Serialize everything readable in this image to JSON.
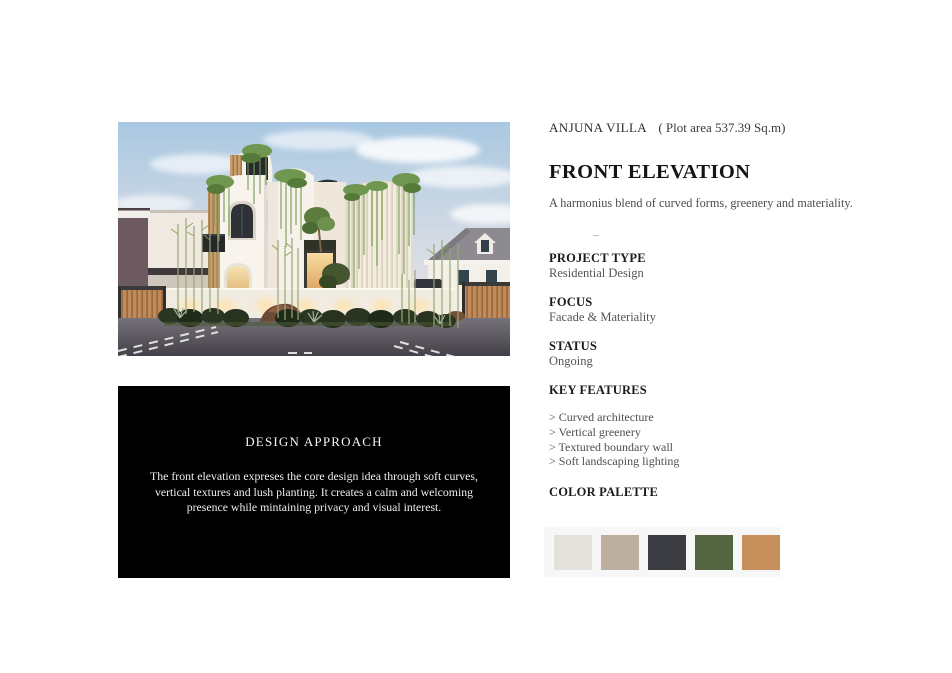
{
  "header": {
    "project_name": "ANJUNA VILLA",
    "plot_area": "( Plot area 537.39 Sq.m)",
    "title": "FRONT ELEVATION",
    "subtitle": "A harmonius blend of curved forms, greenery and materiality.",
    "divider": "–"
  },
  "details": {
    "items": [
      {
        "label": "PROJECT TYPE",
        "value": "Residential Design"
      },
      {
        "label": "FOCUS",
        "value": "Facade & Materiality"
      },
      {
        "label": "STATUS",
        "value": "Ongoing"
      }
    ]
  },
  "key_features": {
    "label": "KEY FEATURES",
    "items": [
      "> Curved architecture",
      "> Vertical greenery",
      "> Textured boundary wall",
      "> Soft landscaping lighting"
    ]
  },
  "color_palette": {
    "label": "COLOR PALETTE",
    "swatches": [
      {
        "name": "off-white",
        "hex": "#e4e1dc"
      },
      {
        "name": "warm-taupe",
        "hex": "#bcafa2"
      },
      {
        "name": "charcoal",
        "hex": "#3a3c42"
      },
      {
        "name": "forest-green",
        "hex": "#53663f"
      },
      {
        "name": "terracotta",
        "hex": "#c6905c"
      }
    ]
  },
  "design_approach": {
    "title": "DESIGN APPROACH",
    "lines": [
      "The front elevation expreses the core design idea through soft curves,",
      "vertical textures and lush planting. It creates a calm and welcoming",
      "presence while mintaining privacy and visual interest."
    ]
  }
}
